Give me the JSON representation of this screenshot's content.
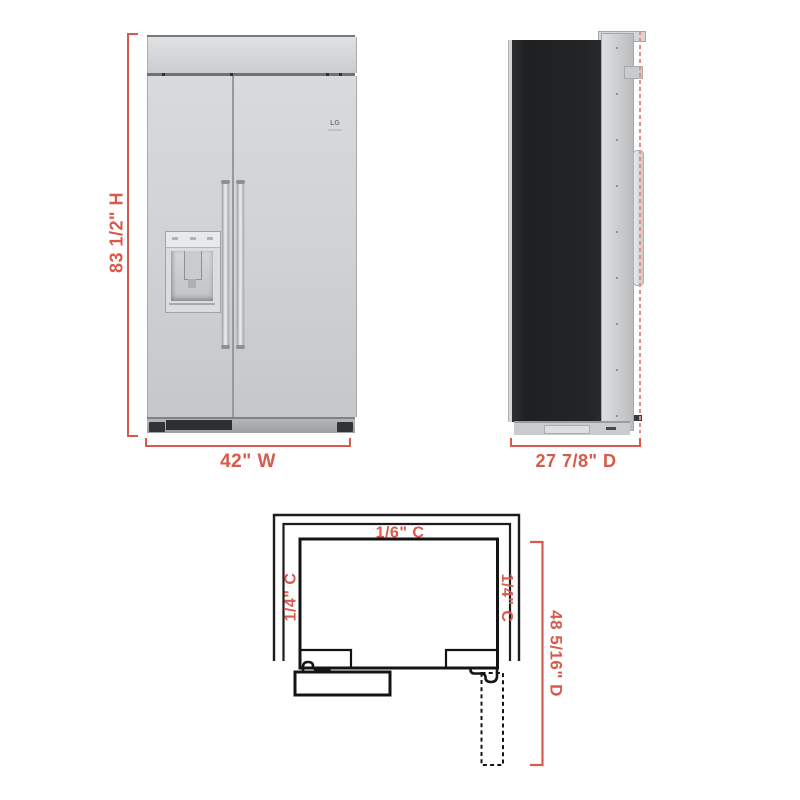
{
  "colors": {
    "dimension_accent": "#d95a4b",
    "dashed_reference": "#e09184",
    "diagram_line": "#1a1a1a",
    "stainless": "#cdcfd1",
    "side_panel_black": "#232426"
  },
  "front_view": {
    "height_label": "83 1/2\" H",
    "width_label": "42\" W",
    "brand": "LG"
  },
  "side_view": {
    "depth_label": "27 7/8\" D"
  },
  "cutout_view": {
    "top_clearance_label": "1/6\" C",
    "left_clearance_label": "1/4\" C",
    "right_clearance_label": "1/4\" C",
    "depth_label": "48 5/16\" D"
  }
}
